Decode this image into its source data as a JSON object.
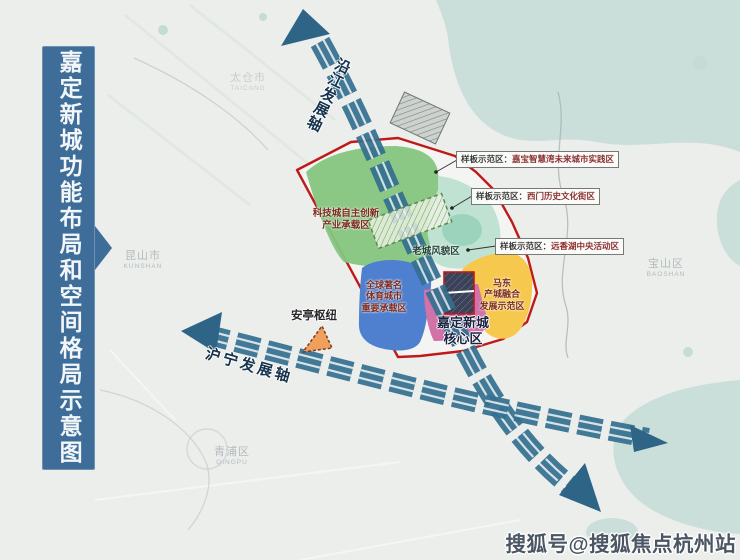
{
  "banner": {
    "title": "嘉定新城功能布局和空间格局示意图"
  },
  "axes": {
    "yanjiang": {
      "label": "沿江发展轴"
    },
    "huning": {
      "label": "沪宁发展轴"
    }
  },
  "zones": {
    "tech": {
      "label": "科技城自主创新\n产业承载区"
    },
    "oldtown": {
      "label": "老城风貌区"
    },
    "sports": {
      "label": "全球著名\n体育城市\n重要承载区"
    },
    "madong": {
      "label": "马东\n产城融合\n发展示范区"
    },
    "core": {
      "label": "嘉定新城\n核心区"
    },
    "anting": {
      "label": "安亭枢纽"
    }
  },
  "callouts": [
    {
      "prefix": "样板示范区：",
      "name": "嘉宝智慧湾未来城市实践区"
    },
    {
      "prefix": "样板示范区：",
      "name": "西门历史文化街区"
    },
    {
      "prefix": "样板示范区：",
      "name": "远香湖中央活动区"
    }
  ],
  "regions": [
    {
      "name": "太仓市",
      "pinyin": "TAICANG"
    },
    {
      "name": "昆山市",
      "pinyin": "KUNSHAN"
    },
    {
      "name": "宝山区",
      "pinyin": "BAOSHAN"
    },
    {
      "name": "青浦区",
      "pinyin": "QINGPU"
    }
  ],
  "watermark": {
    "text": "搜狐号@搜狐焦点杭州站"
  },
  "colors": {
    "banner_blue": "#3d6d98",
    "axis_blue": "#33708f",
    "boundary_red": "#bf1a1a",
    "zone_green": "#85c57f",
    "zone_teal": "#bfe2d3",
    "zone_blue": "#4f80d0",
    "zone_pink": "#d172a8",
    "zone_yellow": "#f6c94e",
    "hub_orange": "#f0a05c",
    "water_teal": "#cbdfda"
  }
}
